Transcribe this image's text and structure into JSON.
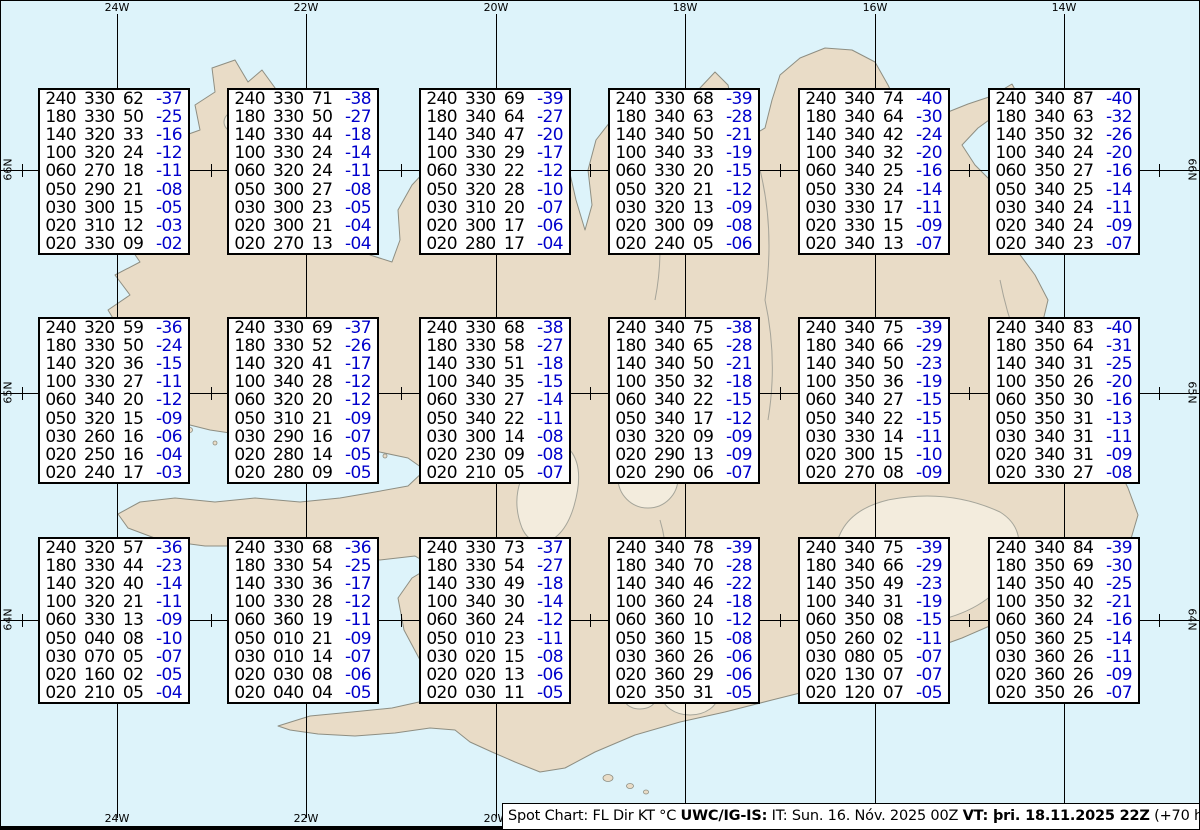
{
  "map": {
    "region": "Iceland",
    "colors": {
      "water": "#ddf3fa",
      "land": "#e9dcc7",
      "coast": "#8e8e82",
      "glacier_fill": "#f3ecdd",
      "glacier_stroke": "#a5a59a",
      "detail_stroke": "#9a9a90",
      "grid": "#000000",
      "temperature_blue": "#0000cc"
    },
    "meridian_labels": [
      "24W",
      "22W",
      "20W",
      "18W",
      "16W",
      "14W"
    ],
    "parallel_labels": [
      "66N",
      "65N",
      "64N"
    ]
  },
  "chart_data": {
    "type": "table",
    "title": "Spot Chart: FL Dir KT °C",
    "source": "UWC/IG-IS:",
    "issue_time": "IT: Sun. 16. Nóv. 2025 00Z",
    "valid_time": "VT: þri. 18.11.2025 22Z",
    "valid_offset": "(+70 h)",
    "columns": [
      "FL",
      "Dir",
      "KT",
      "°C"
    ],
    "x_tick_labels": [
      "24W",
      "22W",
      "20W",
      "18W",
      "16W",
      "14W"
    ],
    "y_tick_labels": [
      "66N",
      "65N",
      "64N"
    ],
    "spots": [
      {
        "row": 0,
        "col": 0,
        "rows": [
          [
            "240",
            "330",
            "62",
            "-37"
          ],
          [
            "180",
            "330",
            "50",
            "-25"
          ],
          [
            "140",
            "320",
            "33",
            "-16"
          ],
          [
            "100",
            "320",
            "24",
            "-12"
          ],
          [
            "060",
            "270",
            "18",
            "-11"
          ],
          [
            "050",
            "290",
            "21",
            "-08"
          ],
          [
            "030",
            "300",
            "15",
            "-05"
          ],
          [
            "020",
            "310",
            "12",
            "-03"
          ],
          [
            "020",
            "330",
            "09",
            "-02"
          ]
        ]
      },
      {
        "row": 0,
        "col": 1,
        "rows": [
          [
            "240",
            "330",
            "71",
            "-38"
          ],
          [
            "180",
            "330",
            "50",
            "-27"
          ],
          [
            "140",
            "330",
            "44",
            "-18"
          ],
          [
            "100",
            "330",
            "24",
            "-14"
          ],
          [
            "060",
            "320",
            "24",
            "-11"
          ],
          [
            "050",
            "300",
            "27",
            "-08"
          ],
          [
            "030",
            "300",
            "23",
            "-05"
          ],
          [
            "020",
            "300",
            "21",
            "-04"
          ],
          [
            "020",
            "270",
            "13",
            "-04"
          ]
        ]
      },
      {
        "row": 0,
        "col": 2,
        "rows": [
          [
            "240",
            "330",
            "69",
            "-39"
          ],
          [
            "180",
            "340",
            "64",
            "-27"
          ],
          [
            "140",
            "340",
            "47",
            "-20"
          ],
          [
            "100",
            "330",
            "29",
            "-17"
          ],
          [
            "060",
            "330",
            "22",
            "-12"
          ],
          [
            "050",
            "320",
            "28",
            "-10"
          ],
          [
            "030",
            "310",
            "20",
            "-07"
          ],
          [
            "020",
            "300",
            "17",
            "-06"
          ],
          [
            "020",
            "280",
            "17",
            "-04"
          ]
        ]
      },
      {
        "row": 0,
        "col": 3,
        "rows": [
          [
            "240",
            "330",
            "68",
            "-39"
          ],
          [
            "180",
            "340",
            "63",
            "-28"
          ],
          [
            "140",
            "340",
            "50",
            "-21"
          ],
          [
            "100",
            "340",
            "33",
            "-19"
          ],
          [
            "060",
            "330",
            "20",
            "-15"
          ],
          [
            "050",
            "320",
            "21",
            "-12"
          ],
          [
            "030",
            "320",
            "13",
            "-09"
          ],
          [
            "020",
            "300",
            "09",
            "-08"
          ],
          [
            "020",
            "240",
            "05",
            "-06"
          ]
        ]
      },
      {
        "row": 0,
        "col": 4,
        "rows": [
          [
            "240",
            "340",
            "74",
            "-40"
          ],
          [
            "180",
            "340",
            "64",
            "-30"
          ],
          [
            "140",
            "340",
            "42",
            "-24"
          ],
          [
            "100",
            "340",
            "32",
            "-20"
          ],
          [
            "060",
            "340",
            "25",
            "-16"
          ],
          [
            "050",
            "330",
            "24",
            "-14"
          ],
          [
            "030",
            "330",
            "17",
            "-11"
          ],
          [
            "020",
            "330",
            "15",
            "-09"
          ],
          [
            "020",
            "340",
            "13",
            "-07"
          ]
        ]
      },
      {
        "row": 0,
        "col": 5,
        "rows": [
          [
            "240",
            "340",
            "87",
            "-40"
          ],
          [
            "180",
            "340",
            "63",
            "-32"
          ],
          [
            "140",
            "350",
            "32",
            "-26"
          ],
          [
            "100",
            "340",
            "24",
            "-20"
          ],
          [
            "060",
            "350",
            "27",
            "-16"
          ],
          [
            "050",
            "340",
            "25",
            "-14"
          ],
          [
            "030",
            "340",
            "24",
            "-11"
          ],
          [
            "020",
            "340",
            "24",
            "-09"
          ],
          [
            "020",
            "340",
            "23",
            "-07"
          ]
        ]
      },
      {
        "row": 1,
        "col": 0,
        "rows": [
          [
            "240",
            "320",
            "59",
            "-36"
          ],
          [
            "180",
            "330",
            "50",
            "-24"
          ],
          [
            "140",
            "320",
            "36",
            "-15"
          ],
          [
            "100",
            "330",
            "27",
            "-11"
          ],
          [
            "060",
            "340",
            "20",
            "-12"
          ],
          [
            "050",
            "320",
            "15",
            "-09"
          ],
          [
            "030",
            "260",
            "16",
            "-06"
          ],
          [
            "020",
            "250",
            "16",
            "-04"
          ],
          [
            "020",
            "240",
            "17",
            "-03"
          ]
        ]
      },
      {
        "row": 1,
        "col": 1,
        "rows": [
          [
            "240",
            "330",
            "69",
            "-37"
          ],
          [
            "180",
            "330",
            "52",
            "-26"
          ],
          [
            "140",
            "320",
            "41",
            "-17"
          ],
          [
            "100",
            "340",
            "28",
            "-12"
          ],
          [
            "060",
            "320",
            "20",
            "-12"
          ],
          [
            "050",
            "310",
            "21",
            "-09"
          ],
          [
            "030",
            "290",
            "16",
            "-07"
          ],
          [
            "020",
            "280",
            "14",
            "-05"
          ],
          [
            "020",
            "280",
            "09",
            "-05"
          ]
        ]
      },
      {
        "row": 1,
        "col": 2,
        "rows": [
          [
            "240",
            "330",
            "68",
            "-38"
          ],
          [
            "180",
            "330",
            "58",
            "-27"
          ],
          [
            "140",
            "330",
            "51",
            "-18"
          ],
          [
            "100",
            "340",
            "35",
            "-15"
          ],
          [
            "060",
            "330",
            "27",
            "-14"
          ],
          [
            "050",
            "340",
            "22",
            "-11"
          ],
          [
            "030",
            "300",
            "14",
            "-08"
          ],
          [
            "020",
            "230",
            "09",
            "-08"
          ],
          [
            "020",
            "210",
            "05",
            "-07"
          ]
        ]
      },
      {
        "row": 1,
        "col": 3,
        "rows": [
          [
            "240",
            "340",
            "75",
            "-38"
          ],
          [
            "180",
            "340",
            "65",
            "-28"
          ],
          [
            "140",
            "340",
            "50",
            "-21"
          ],
          [
            "100",
            "350",
            "32",
            "-18"
          ],
          [
            "060",
            "340",
            "22",
            "-15"
          ],
          [
            "050",
            "340",
            "17",
            "-12"
          ],
          [
            "030",
            "320",
            "09",
            "-09"
          ],
          [
            "020",
            "290",
            "13",
            "-09"
          ],
          [
            "020",
            "290",
            "06",
            "-07"
          ]
        ]
      },
      {
        "row": 1,
        "col": 4,
        "rows": [
          [
            "240",
            "340",
            "75",
            "-39"
          ],
          [
            "180",
            "340",
            "66",
            "-29"
          ],
          [
            "140",
            "340",
            "50",
            "-23"
          ],
          [
            "100",
            "350",
            "36",
            "-19"
          ],
          [
            "060",
            "340",
            "27",
            "-15"
          ],
          [
            "050",
            "340",
            "22",
            "-15"
          ],
          [
            "030",
            "330",
            "14",
            "-11"
          ],
          [
            "020",
            "300",
            "15",
            "-10"
          ],
          [
            "020",
            "270",
            "08",
            "-09"
          ]
        ]
      },
      {
        "row": 1,
        "col": 5,
        "rows": [
          [
            "240",
            "340",
            "83",
            "-40"
          ],
          [
            "180",
            "350",
            "64",
            "-31"
          ],
          [
            "140",
            "340",
            "31",
            "-25"
          ],
          [
            "100",
            "350",
            "26",
            "-20"
          ],
          [
            "060",
            "350",
            "30",
            "-16"
          ],
          [
            "050",
            "350",
            "31",
            "-13"
          ],
          [
            "030",
            "340",
            "31",
            "-11"
          ],
          [
            "020",
            "340",
            "31",
            "-09"
          ],
          [
            "020",
            "330",
            "27",
            "-08"
          ]
        ]
      },
      {
        "row": 2,
        "col": 0,
        "rows": [
          [
            "240",
            "320",
            "57",
            "-36"
          ],
          [
            "180",
            "330",
            "44",
            "-23"
          ],
          [
            "140",
            "320",
            "40",
            "-14"
          ],
          [
            "100",
            "320",
            "21",
            "-11"
          ],
          [
            "060",
            "330",
            "13",
            "-09"
          ],
          [
            "050",
            "040",
            "08",
            "-10"
          ],
          [
            "030",
            "070",
            "05",
            "-07"
          ],
          [
            "020",
            "160",
            "02",
            "-05"
          ],
          [
            "020",
            "210",
            "05",
            "-04"
          ]
        ]
      },
      {
        "row": 2,
        "col": 1,
        "rows": [
          [
            "240",
            "330",
            "68",
            "-36"
          ],
          [
            "180",
            "330",
            "54",
            "-25"
          ],
          [
            "140",
            "330",
            "36",
            "-17"
          ],
          [
            "100",
            "330",
            "28",
            "-12"
          ],
          [
            "060",
            "360",
            "19",
            "-11"
          ],
          [
            "050",
            "010",
            "21",
            "-09"
          ],
          [
            "030",
            "010",
            "14",
            "-07"
          ],
          [
            "020",
            "030",
            "08",
            "-06"
          ],
          [
            "020",
            "040",
            "04",
            "-05"
          ]
        ]
      },
      {
        "row": 2,
        "col": 2,
        "rows": [
          [
            "240",
            "330",
            "73",
            "-37"
          ],
          [
            "180",
            "330",
            "54",
            "-27"
          ],
          [
            "140",
            "330",
            "49",
            "-18"
          ],
          [
            "100",
            "340",
            "30",
            "-14"
          ],
          [
            "060",
            "360",
            "24",
            "-12"
          ],
          [
            "050",
            "010",
            "23",
            "-11"
          ],
          [
            "030",
            "020",
            "15",
            "-08"
          ],
          [
            "020",
            "020",
            "13",
            "-06"
          ],
          [
            "020",
            "030",
            "11",
            "-05"
          ]
        ]
      },
      {
        "row": 2,
        "col": 3,
        "rows": [
          [
            "240",
            "340",
            "78",
            "-39"
          ],
          [
            "180",
            "340",
            "70",
            "-28"
          ],
          [
            "140",
            "340",
            "46",
            "-22"
          ],
          [
            "100",
            "360",
            "24",
            "-18"
          ],
          [
            "060",
            "360",
            "10",
            "-12"
          ],
          [
            "050",
            "360",
            "15",
            "-08"
          ],
          [
            "030",
            "360",
            "26",
            "-06"
          ],
          [
            "020",
            "360",
            "29",
            "-06"
          ],
          [
            "020",
            "350",
            "31",
            "-05"
          ]
        ]
      },
      {
        "row": 2,
        "col": 4,
        "rows": [
          [
            "240",
            "340",
            "75",
            "-39"
          ],
          [
            "180",
            "340",
            "66",
            "-29"
          ],
          [
            "140",
            "350",
            "49",
            "-23"
          ],
          [
            "100",
            "340",
            "31",
            "-19"
          ],
          [
            "060",
            "350",
            "08",
            "-15"
          ],
          [
            "050",
            "260",
            "02",
            "-11"
          ],
          [
            "030",
            "080",
            "05",
            "-07"
          ],
          [
            "020",
            "130",
            "07",
            "-07"
          ],
          [
            "020",
            "120",
            "07",
            "-05"
          ]
        ]
      },
      {
        "row": 2,
        "col": 5,
        "rows": [
          [
            "240",
            "340",
            "84",
            "-39"
          ],
          [
            "180",
            "350",
            "69",
            "-30"
          ],
          [
            "140",
            "350",
            "40",
            "-25"
          ],
          [
            "100",
            "350",
            "32",
            "-21"
          ],
          [
            "060",
            "360",
            "24",
            "-16"
          ],
          [
            "050",
            "360",
            "25",
            "-14"
          ],
          [
            "030",
            "360",
            "26",
            "-11"
          ],
          [
            "020",
            "360",
            "26",
            "-09"
          ],
          [
            "020",
            "350",
            "26",
            "-07"
          ]
        ]
      }
    ]
  },
  "status_bar": {
    "prefix": "Spot Chart: FL Dir KT °C ",
    "source_bold": "UWC/IG-IS:",
    "issue_normal": " IT: Sun. 16. Nóv. 2025 00Z ",
    "valid_bold": "VT: þri. 18.11.2025 22Z",
    "suffix": " (+70 h)"
  }
}
